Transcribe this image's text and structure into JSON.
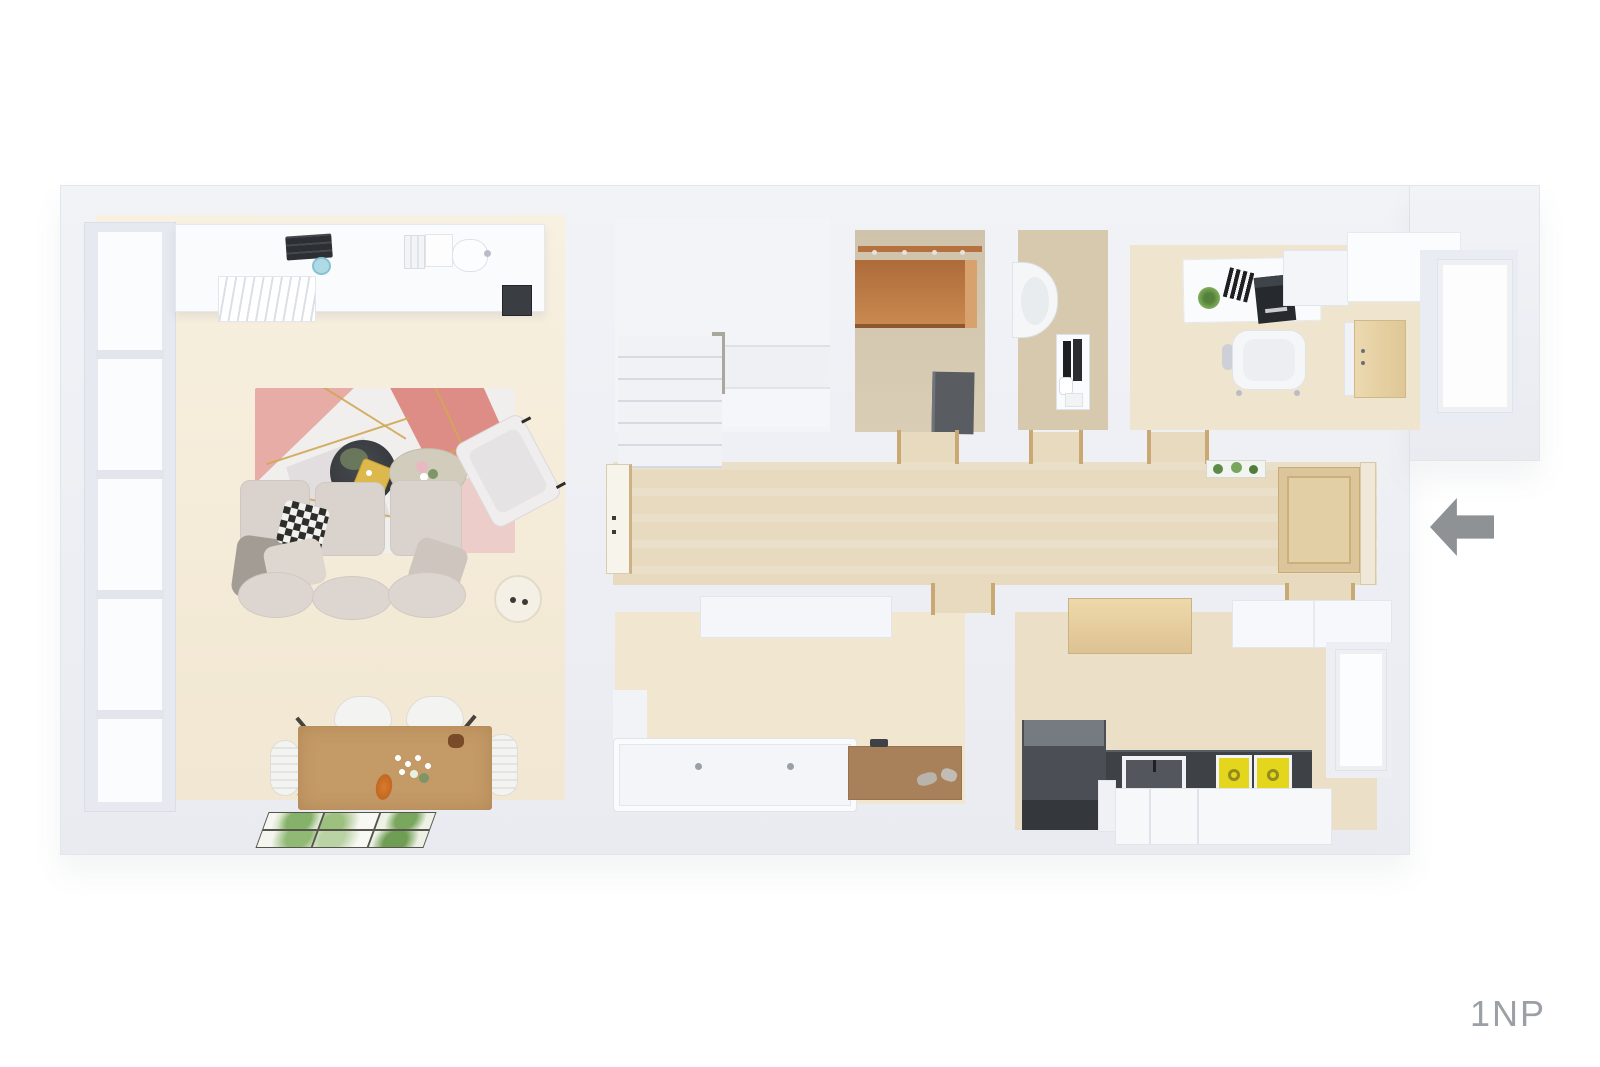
{
  "page": {
    "background": "#ffffff",
    "floor_label": "1NP",
    "floor_label_color": "#9aa0a5"
  },
  "plan": {
    "entrance_arrow_icon": "arrow-left",
    "colors": {
      "wall": "#ebedf2",
      "corridor_floor": "#e7dabf",
      "living_floor": "#f4ebd8",
      "wood_accent": "#b5713f",
      "entrance_door_wood": "#dcc59b",
      "dining_table_wood": "#c49a67",
      "counter_dark": "#3e4247",
      "appliance_yellow": "#e4d51d",
      "bath_mat_brown": "#a8815a",
      "rug_pink": "#dd8d85",
      "rug_gold": "#cfa757",
      "arrow_gray": "#8f9295"
    }
  }
}
